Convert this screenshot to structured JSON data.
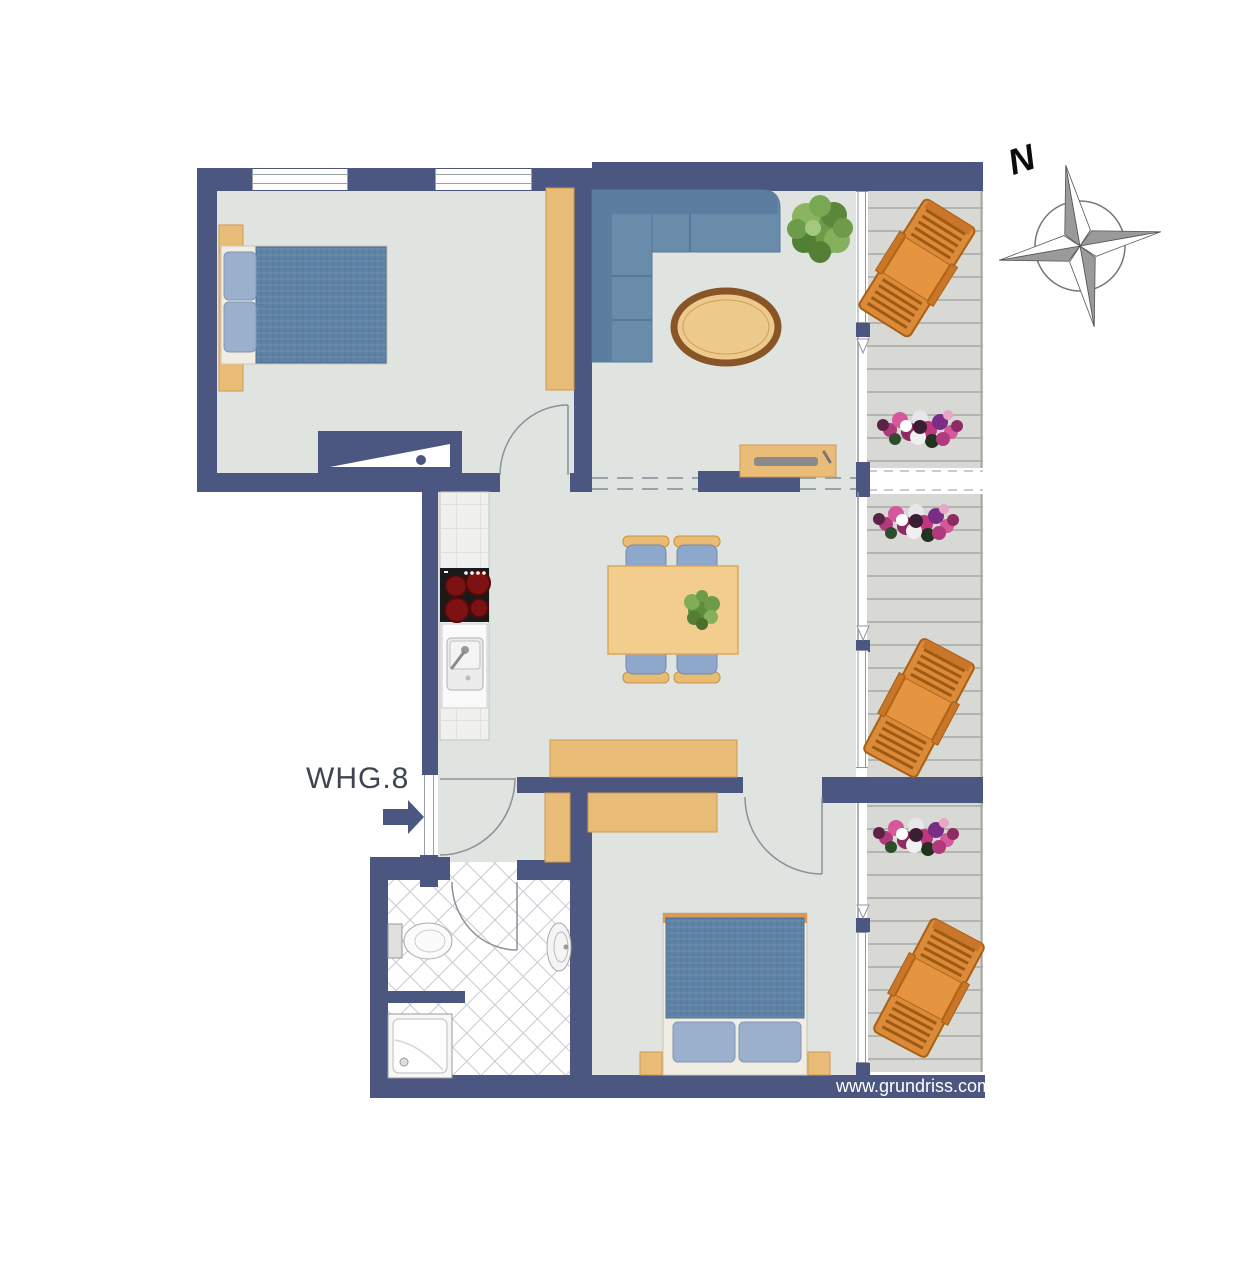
{
  "plan": {
    "labels": {
      "apartment_number": "WHG.8",
      "compass_north": "N",
      "watermark": "www.grundriss.com"
    },
    "colors": {
      "wall": "#4b5780",
      "floor": "#e0e4e0",
      "balcony_deck": "#d8d8d4",
      "deck_plank_line": "#b4b4b0",
      "furniture_wood": "#e9bc77",
      "table_wood": "#f2cd8d",
      "sofa_blue": "#6a8cab",
      "bed_blanket_blue": "#5e82a5",
      "pillow_blue": "#9bb0cd",
      "chair_seat_blue": "#8ea8cc",
      "lounger_orange": "#db8a39",
      "cooktop_black": "#1a1a1a",
      "burner_red": "#7e1212",
      "bathroom_tile_line": "#c6cad0",
      "door_arc_line": "#8b9099",
      "flower_pink": "#c2357f",
      "plant_green": "#6e9b49"
    },
    "icons": {
      "compass": "compass-rose-icon",
      "entrance_arrow": "arrow-right-icon",
      "chimney": "chimney-flue-symbol"
    }
  }
}
